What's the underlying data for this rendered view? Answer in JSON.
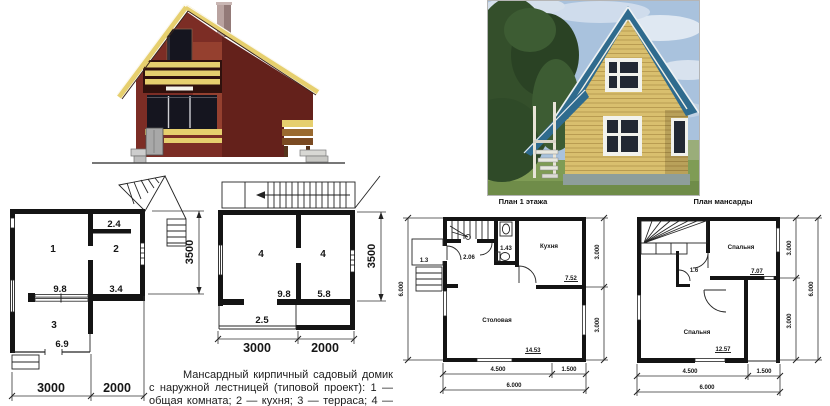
{
  "palette": {
    "ink": "#161616",
    "elevation_wall": "#7c2d25",
    "elevation_wall_dark": "#64211b",
    "elevation_recess": "#95402f",
    "elevation_trim": "#e6cf6e",
    "window_glass": "#15151f",
    "photo_sky": "#a9c2dd",
    "photo_tree": "#344f2b",
    "photo_grass": "#7f9c55",
    "photo_wall": "#d9bf6e",
    "photo_roof": "#2f6b8e"
  },
  "titles": {
    "floor1": "План 1 этажа",
    "attic": "План мансарды"
  },
  "caption": "Мансардный кирпичный садовый домик с наружной лестницей (типовой проект): 1 — общая комната; 2 — кухня; 3 — терраса; 4 — спальня",
  "plan_left_floor1": {
    "room1": "1",
    "room2": "2",
    "room3": "3",
    "area_vestibule": "2.4",
    "area_mid": "9.8",
    "area_kitchen": "3.4",
    "area_terrace": "6.9",
    "dim_w1": "3000",
    "dim_w2": "2000",
    "dim_h": "3500"
  },
  "plan_left_attic": {
    "room_left": "4",
    "room_right": "4",
    "area_left": "9.8",
    "area_right": "5.8",
    "area_balcony": "2.5",
    "dim_w1": "3000",
    "dim_w2": "2000",
    "dim_h": "3500"
  },
  "plan_floor1": {
    "room_kitchen": "Кухня",
    "room_dining": "Столовая",
    "area_porch": "1.3",
    "area_hall": "2.06",
    "area_wc": "1.43",
    "area_kitchen": "7.52",
    "area_dining": "14.53",
    "dim_b1": "4.500",
    "dim_b2": "1.500",
    "dim_total": "6.000",
    "dim_left": "6.000",
    "dim_r1": "3.000",
    "dim_r2": "3.000"
  },
  "plan_attic": {
    "room_bed1": "Спальня",
    "room_bed2": "Спальня",
    "area_closet": "1.6",
    "area_bed1": "7.07",
    "area_bed2": "12.57",
    "dim_b1": "4.500",
    "dim_b2": "1.500",
    "dim_total": "6.000",
    "dim_r1": "3.000",
    "dim_r2": "3.000",
    "dim_right_total": "6.000"
  }
}
